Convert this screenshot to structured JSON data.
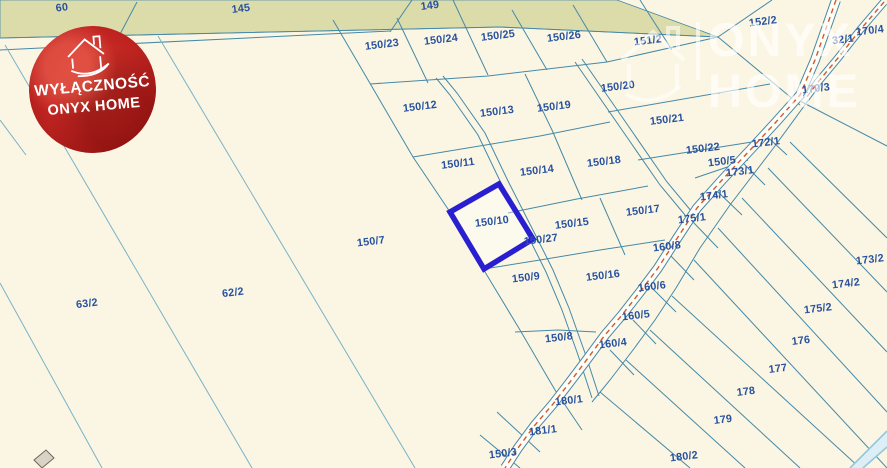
{
  "map": {
    "width": 887,
    "height": 468,
    "colors": {
      "background": "#fbf6e3",
      "strip_fill": "#dcdcab",
      "line_sub": "#4589a8",
      "line_field": "#79b2c6",
      "line_light": "#93c8db",
      "road_fill": "#fefdf6",
      "road_dash": "#d4572e",
      "label": "#27519f",
      "highlight": "#2a1fd0",
      "building_fill": "#d9d2c6",
      "building_stroke": "#70675c",
      "corner_fill": "#ddeef6"
    },
    "label_style": {
      "size": 10.8,
      "rotation": -7
    },
    "labels": [
      {
        "t": "60",
        "x": 62,
        "y": 8
      },
      {
        "t": "145",
        "x": 241,
        "y": 9
      },
      {
        "t": "149",
        "x": 430,
        "y": 6
      },
      {
        "t": "150/23",
        "x": 382,
        "y": 45
      },
      {
        "t": "150/24",
        "x": 441,
        "y": 40
      },
      {
        "t": "150/25",
        "x": 498,
        "y": 36
      },
      {
        "t": "150/26",
        "x": 564,
        "y": 37
      },
      {
        "t": "151/2",
        "x": 648,
        "y": 41
      },
      {
        "t": "152/2",
        "x": 763,
        "y": 22
      },
      {
        "t": "32/1",
        "x": 843,
        "y": 40
      },
      {
        "t": "170/4",
        "x": 870,
        "y": 31
      },
      {
        "t": "170/3",
        "x": 816,
        "y": 89
      },
      {
        "t": "150/12",
        "x": 420,
        "y": 107
      },
      {
        "t": "150/13",
        "x": 497,
        "y": 112
      },
      {
        "t": "150/19",
        "x": 554,
        "y": 107
      },
      {
        "t": "150/20",
        "x": 618,
        "y": 87
      },
      {
        "t": "150/21",
        "x": 667,
        "y": 120
      },
      {
        "t": "150/22",
        "x": 703,
        "y": 149
      },
      {
        "t": "150/11",
        "x": 458,
        "y": 164
      },
      {
        "t": "150/14",
        "x": 537,
        "y": 171
      },
      {
        "t": "150/18",
        "x": 604,
        "y": 162
      },
      {
        "t": "150/5",
        "x": 722,
        "y": 162
      },
      {
        "t": "173/1",
        "x": 740,
        "y": 172
      },
      {
        "t": "172/1",
        "x": 766,
        "y": 143
      },
      {
        "t": "150/10",
        "x": 492,
        "y": 222
      },
      {
        "t": "150/15",
        "x": 572,
        "y": 224
      },
      {
        "t": "150/17",
        "x": 643,
        "y": 211
      },
      {
        "t": "174/1",
        "x": 714,
        "y": 196
      },
      {
        "t": "175/1",
        "x": 692,
        "y": 219
      },
      {
        "t": "150/27",
        "x": 541,
        "y": 240
      },
      {
        "t": "150/7",
        "x": 371,
        "y": 242
      },
      {
        "t": "150/9",
        "x": 526,
        "y": 278
      },
      {
        "t": "150/16",
        "x": 603,
        "y": 276
      },
      {
        "t": "160/8",
        "x": 667,
        "y": 247
      },
      {
        "t": "160/6",
        "x": 652,
        "y": 287
      },
      {
        "t": "160/5",
        "x": 636,
        "y": 316
      },
      {
        "t": "160/4",
        "x": 613,
        "y": 344
      },
      {
        "t": "63/2",
        "x": 87,
        "y": 304
      },
      {
        "t": "62/2",
        "x": 233,
        "y": 293
      },
      {
        "t": "150/8",
        "x": 559,
        "y": 338
      },
      {
        "t": "173/2",
        "x": 870,
        "y": 260
      },
      {
        "t": "174/2",
        "x": 846,
        "y": 284
      },
      {
        "t": "175/2",
        "x": 818,
        "y": 309
      },
      {
        "t": "176",
        "x": 801,
        "y": 341
      },
      {
        "t": "177",
        "x": 778,
        "y": 369
      },
      {
        "t": "178",
        "x": 746,
        "y": 392
      },
      {
        "t": "179",
        "x": 723,
        "y": 420
      },
      {
        "t": "180/2",
        "x": 684,
        "y": 457
      },
      {
        "t": "180/1",
        "x": 569,
        "y": 401
      },
      {
        "t": "181/1",
        "x": 543,
        "y": 431
      },
      {
        "t": "150/3",
        "x": 503,
        "y": 454
      }
    ],
    "strip_polygon": [
      [
        0,
        0
      ],
      [
        617,
        0
      ],
      [
        718,
        37
      ],
      [
        500,
        27
      ],
      [
        0,
        38
      ]
    ],
    "lines": [
      {
        "cls": "sub",
        "pts": [
          [
            0,
            38
          ],
          [
            500,
            27
          ],
          [
            718,
            37
          ]
        ]
      },
      {
        "cls": "sub",
        "pts": [
          [
            0,
            50
          ],
          [
            390,
            31
          ]
        ]
      },
      {
        "cls": "field",
        "pts": [
          [
            5,
            45
          ],
          [
            252,
            468
          ]
        ]
      },
      {
        "cls": "field",
        "pts": [
          [
            158,
            36
          ],
          [
            415,
            468
          ]
        ]
      },
      {
        "cls": "field",
        "pts": [
          [
            0,
            283
          ],
          [
            102,
            468
          ]
        ]
      },
      {
        "cls": "field",
        "pts": [
          [
            0,
            120
          ],
          [
            26,
            155
          ]
        ]
      },
      {
        "cls": "sub",
        "pts": [
          [
            137,
            2
          ],
          [
            118,
            38
          ]
        ]
      },
      {
        "cls": "sub",
        "pts": [
          [
            412,
            0
          ],
          [
            390,
            32
          ]
        ]
      },
      {
        "cls": "sub",
        "pts": [
          [
            453,
            0
          ],
          [
            488,
            75
          ]
        ]
      },
      {
        "cls": "sub",
        "pts": [
          [
            397,
            18
          ],
          [
            428,
            83
          ]
        ]
      },
      {
        "cls": "sub",
        "pts": [
          [
            512,
            10
          ],
          [
            547,
            70
          ]
        ]
      },
      {
        "cls": "sub",
        "pts": [
          [
            573,
            5
          ],
          [
            607,
            62
          ]
        ]
      },
      {
        "cls": "sub",
        "pts": [
          [
            640,
            0
          ],
          [
            672,
            50
          ]
        ]
      },
      {
        "cls": "sub",
        "pts": [
          [
            370,
            84
          ],
          [
            488,
            76
          ],
          [
            607,
            62
          ],
          [
            718,
            37
          ]
        ]
      },
      {
        "cls": "sub",
        "pts": [
          [
            718,
            37
          ],
          [
            772,
            0
          ]
        ]
      },
      {
        "cls": "sub",
        "pts": [
          [
            718,
            37
          ],
          [
            800,
            105
          ]
        ]
      },
      {
        "cls": "sub",
        "pts": [
          [
            333,
            20
          ],
          [
            413,
            157
          ],
          [
            450,
            212
          ],
          [
            482,
            267
          ],
          [
            520,
            330
          ],
          [
            555,
            390
          ],
          [
            582,
            430
          ]
        ]
      },
      {
        "cls": "sub",
        "pts": [
          [
            413,
            157
          ],
          [
            540,
            136
          ],
          [
            610,
            122
          ]
        ]
      },
      {
        "cls": "sub",
        "pts": [
          [
            525,
            74
          ],
          [
            552,
            130
          ],
          [
            582,
            200
          ]
        ]
      },
      {
        "cls": "sub",
        "pts": [
          [
            450,
            212
          ],
          [
            499,
            184
          ]
        ]
      },
      {
        "cls": "sub",
        "pts": [
          [
            508,
            213
          ],
          [
            577,
            199
          ],
          [
            648,
            186
          ]
        ]
      },
      {
        "cls": "sub",
        "pts": [
          [
            600,
            198
          ],
          [
            625,
            255
          ]
        ]
      },
      {
        "cls": "sub",
        "pts": [
          [
            484,
            269
          ],
          [
            540,
            260
          ],
          [
            600,
            250
          ],
          [
            665,
            240
          ]
        ]
      },
      {
        "cls": "sub",
        "pts": [
          [
            515,
            332
          ],
          [
            558,
            330
          ],
          [
            596,
            332
          ]
        ]
      },
      {
        "cls": "sub",
        "pts": [
          [
            436,
            78
          ],
          [
            450,
            95
          ],
          [
            478,
            135
          ],
          [
            501,
            183
          ],
          [
            530,
            240
          ],
          [
            546,
            272
          ],
          [
            562,
            310
          ],
          [
            578,
            355
          ],
          [
            592,
            398
          ]
        ]
      },
      {
        "cls": "sub",
        "pts": [
          [
            443,
            76
          ],
          [
            457,
            93
          ],
          [
            485,
            133
          ],
          [
            508,
            181
          ],
          [
            537,
            238
          ],
          [
            553,
            270
          ],
          [
            569,
            308
          ],
          [
            585,
            353
          ],
          [
            599,
            396
          ]
        ]
      },
      {
        "cls": "sub",
        "pts": [
          [
            575,
            62
          ],
          [
            622,
            130
          ],
          [
            660,
            185
          ],
          [
            685,
            215
          ]
        ]
      },
      {
        "cls": "sub",
        "pts": [
          [
            582,
            59
          ],
          [
            629,
            127
          ],
          [
            667,
            182
          ],
          [
            692,
            212
          ]
        ]
      },
      {
        "cls": "sub",
        "pts": [
          [
            608,
            112
          ],
          [
            770,
            84
          ]
        ]
      },
      {
        "cls": "sub",
        "pts": [
          [
            638,
            160
          ],
          [
            752,
            142
          ]
        ]
      },
      {
        "cls": "sub",
        "pts": [
          [
            695,
            178
          ],
          [
            748,
            160
          ]
        ]
      },
      {
        "cls": "sub",
        "pts": [
          [
            810,
            98
          ],
          [
            772,
            150
          ],
          [
            730,
            205
          ],
          [
            700,
            248
          ],
          [
            676,
            288
          ],
          [
            655,
            320
          ],
          [
            633,
            350
          ],
          [
            610,
            380
          ],
          [
            592,
            402
          ]
        ]
      },
      {
        "cls": "sub",
        "pts": [
          [
            798,
            100
          ],
          [
            887,
            146
          ]
        ]
      },
      {
        "cls": "sub",
        "pts": [
          [
            790,
            142
          ],
          [
            887,
            238
          ]
        ]
      },
      {
        "cls": "sub",
        "pts": [
          [
            768,
            168
          ],
          [
            887,
            292
          ]
        ]
      },
      {
        "cls": "sub",
        "pts": [
          [
            742,
            198
          ],
          [
            887,
            352
          ]
        ]
      },
      {
        "cls": "sub",
        "pts": [
          [
            718,
            228
          ],
          [
            887,
            412
          ]
        ]
      },
      {
        "cls": "sub",
        "pts": [
          [
            694,
            260
          ],
          [
            887,
            468
          ]
        ]
      },
      {
        "cls": "sub",
        "pts": [
          [
            672,
            296
          ],
          [
            860,
            468
          ]
        ]
      },
      {
        "cls": "sub",
        "pts": [
          [
            650,
            330
          ],
          [
            800,
            468
          ]
        ]
      },
      {
        "cls": "sub",
        "pts": [
          [
            626,
            360
          ],
          [
            745,
            468
          ]
        ]
      },
      {
        "cls": "sub",
        "pts": [
          [
            600,
            392
          ],
          [
            690,
            468
          ]
        ]
      },
      {
        "cls": "sub",
        "pts": [
          [
            762,
            132
          ],
          [
            787,
            155
          ]
        ]
      },
      {
        "cls": "sub",
        "pts": [
          [
            740,
            160
          ],
          [
            765,
            185
          ]
        ]
      },
      {
        "cls": "sub",
        "pts": [
          [
            716,
            190
          ],
          [
            742,
            215
          ]
        ]
      },
      {
        "cls": "sub",
        "pts": [
          [
            693,
            222
          ],
          [
            718,
            248
          ]
        ]
      },
      {
        "cls": "sub",
        "pts": [
          [
            670,
            255
          ],
          [
            694,
            280
          ]
        ]
      },
      {
        "cls": "sub",
        "pts": [
          [
            652,
            288
          ],
          [
            676,
            312
          ]
        ]
      },
      {
        "cls": "sub",
        "pts": [
          [
            633,
            320
          ],
          [
            656,
            344
          ]
        ]
      },
      {
        "cls": "sub",
        "pts": [
          [
            610,
            350
          ],
          [
            634,
            375
          ]
        ]
      },
      {
        "cls": "sub",
        "pts": [
          [
            497,
            412
          ],
          [
            540,
            452
          ]
        ]
      },
      {
        "cls": "sub",
        "pts": [
          [
            480,
            435
          ],
          [
            520,
            468
          ]
        ]
      }
    ],
    "roads": [
      {
        "name": "main-road",
        "width": 9,
        "pts": [
          [
            836,
            0
          ],
          [
            815,
            60
          ],
          [
            800,
            95
          ],
          [
            776,
            122
          ],
          [
            752,
            148
          ],
          [
            722,
            180
          ],
          [
            697,
            208
          ],
          [
            676,
            240
          ],
          [
            658,
            268
          ],
          [
            640,
            292
          ],
          [
            622,
            315
          ],
          [
            605,
            335
          ],
          [
            588,
            358
          ],
          [
            570,
            382
          ],
          [
            553,
            404
          ],
          [
            535,
            425
          ],
          [
            518,
            448
          ],
          [
            505,
            468
          ]
        ]
      },
      {
        "name": "upper-road",
        "width": 7,
        "pts": [
          [
            884,
            2
          ],
          [
            860,
            30
          ],
          [
            838,
            58
          ],
          [
            818,
            82
          ],
          [
            806,
            98
          ]
        ]
      }
    ],
    "corner_band": {
      "polygon": [
        [
          850,
          468
        ],
        [
          887,
          431
        ],
        [
          887,
          447
        ],
        [
          863,
          468
        ]
      ],
      "edges": [
        [
          [
            850,
            468
          ],
          [
            887,
            431
          ]
        ],
        [
          [
            863,
            468
          ],
          [
            887,
            447
          ]
        ]
      ]
    },
    "building_polygon": [
      [
        34,
        460
      ],
      [
        46,
        450
      ],
      [
        54,
        458
      ],
      [
        42,
        468
      ]
    ],
    "highlight": {
      "label": "150/10",
      "polygon": [
        [
          499,
          184
        ],
        [
          533,
          239
        ],
        [
          484,
          269
        ],
        [
          450,
          212
        ]
      ]
    }
  },
  "badge": {
    "line1": "WYŁĄCZNOŚĆ",
    "line2": "ONYX HOME"
  },
  "watermark": {
    "line1": "ONYX",
    "line2": "HOME"
  }
}
